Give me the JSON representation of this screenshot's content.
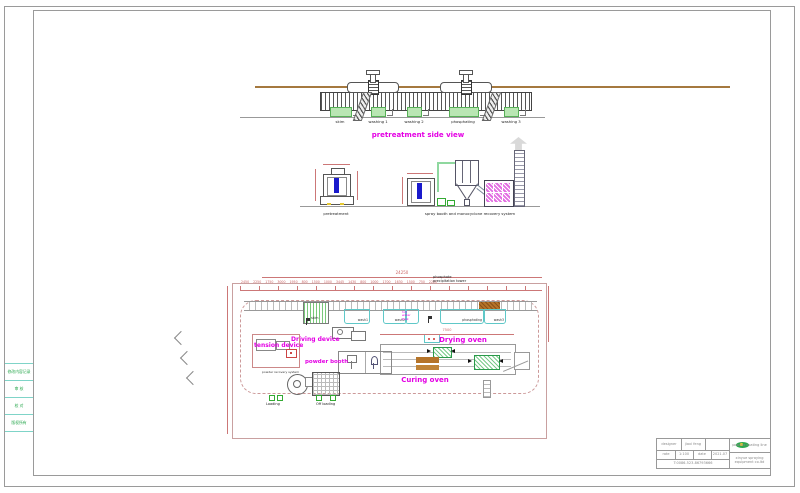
{
  "left_table": {
    "rows": [
      "修改内容记录",
      "审 核",
      "校 对",
      "版权所有"
    ]
  },
  "top_view": {
    "title": "pretreatment side view",
    "tanks": [
      {
        "label": "skim"
      },
      {
        "label": "washing 1"
      },
      {
        "label": "washing 2"
      },
      {
        "label": "phosphating"
      },
      {
        "label": "washing 3"
      }
    ]
  },
  "elevations": {
    "left_label": "pretreatment",
    "right_label": "spray booth and monocyclone recovery system"
  },
  "plan": {
    "note": "phosphate precipitation tower",
    "overall_dim": "24250",
    "dim_chain": "2450 2250 1750 3000 1950 800 1500 1000 3445 1430 800 1000 1700 1630 1500 750 2200",
    "oven_dim": "7500",
    "labels": {
      "driving_device": "Driving device",
      "tension_device": "tension device",
      "powder_booth": "powder booth",
      "powder_recovery": "powder recovery system",
      "drying_oven": "Drying oven",
      "curing_oven": "Curing oven",
      "loading": "Loading",
      "offloading": "Off loading",
      "hot_water": "hot water tank"
    },
    "tanks": [
      {
        "label": "skim"
      },
      {
        "label": "wash1"
      },
      {
        "label": "wash2"
      },
      {
        "label": "phosphating"
      },
      {
        "label": "wash3"
      }
    ]
  },
  "title_block": {
    "designer_label": "designer",
    "designer_value": "jiaxi feng",
    "rate_label": "rate",
    "rate_value": "1:100",
    "date_label": "date",
    "date_value": "2021.07",
    "phone": "T:0086-523-86793666",
    "product": "powder coating line",
    "company": "xinyue spraying equipment co.ltd"
  },
  "colors": {
    "magenta_label": "#e400e4",
    "dimension_red": "#cc6666",
    "tank_cyan": "#5fc8c8",
    "tank_green_fill": "#b9e6b3",
    "rail_brown": "#a5793f",
    "booth_blue": "#1a1acc",
    "logo_green": "#2fa84f"
  }
}
